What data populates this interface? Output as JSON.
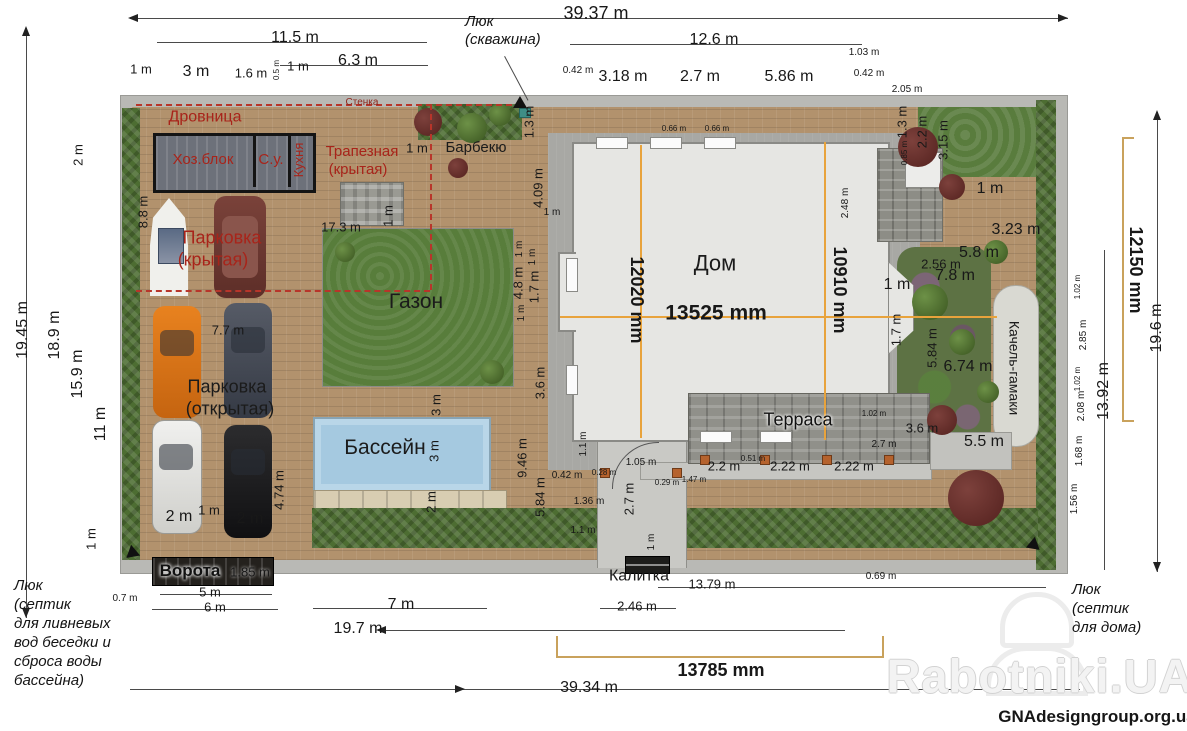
{
  "areas": {
    "drovnitsa": "Дровница",
    "hozblok": "Хоз.блок",
    "su": "С.у.",
    "kuhnya": "Кухня",
    "trapeznaya_1": "Трапезная",
    "trapeznaya_2": "(крытая)",
    "barbekyu": "Барбекю",
    "stenka": "Стенка",
    "park_kr_1": "Парковка",
    "park_kr_2": "(крытая)",
    "park_ot_1": "Парковка",
    "park_ot_2": "(открытая)",
    "gazon": "Газон",
    "bassein": "Бассейн",
    "dom": "Дом",
    "terrasa": "Терраса",
    "vorota": "Ворота",
    "kalitka": "Калитка",
    "kacheli": "Качель-гамаки"
  },
  "annotations": {
    "well": [
      "Люк",
      "(скважина)"
    ],
    "septic_left": [
      "Люк",
      "(септик",
      "для ливневых",
      "вод беседки и",
      "сброса воды",
      "бассейна)"
    ],
    "septic_right": [
      "Люк",
      "(септик",
      "для дома)"
    ]
  },
  "watermark": {
    "brand": "Rabotniki.UA",
    "site": "GNAdesigngroup.org.ua"
  },
  "dims": [
    {
      "t": "39.37 m"
    },
    {
      "t": "11.5 m"
    },
    {
      "t": "6.3 m"
    },
    {
      "t": "1 m"
    },
    {
      "t": "3 m"
    },
    {
      "t": "1.6 m"
    },
    {
      "t": "0.5 m"
    },
    {
      "t": "1 m"
    },
    {
      "t": "12.6 m"
    },
    {
      "t": "0.42 m"
    },
    {
      "t": "3.18 m"
    },
    {
      "t": "2.7 m"
    },
    {
      "t": "5.86 m"
    },
    {
      "t": "1.03 m"
    },
    {
      "t": "0.42 m"
    },
    {
      "t": "2.05 m"
    },
    {
      "t": "1.3 m"
    },
    {
      "t": "1.3 m"
    },
    {
      "t": "0.85 m"
    },
    {
      "t": "2.2 m"
    },
    {
      "t": "3.15 m"
    },
    {
      "t": "0.66 m"
    },
    {
      "t": "0.66 m"
    },
    {
      "t": "19.45 m"
    },
    {
      "t": "18.9 m"
    },
    {
      "t": "15.9 m"
    },
    {
      "t": "11 m"
    },
    {
      "t": "2 m"
    },
    {
      "t": "8.8 m"
    },
    {
      "t": "1 m"
    },
    {
      "t": "0.7 m"
    },
    {
      "t": "17.3 m"
    },
    {
      "t": "1 m"
    },
    {
      "t": "7.7 m"
    },
    {
      "t": "4.09 m"
    },
    {
      "t": "1 m"
    },
    {
      "t": "1 m"
    },
    {
      "t": "1 m"
    },
    {
      "t": "4.8 m"
    },
    {
      "t": "1.7 m"
    },
    {
      "t": "1 m"
    },
    {
      "t": "3.6 m"
    },
    {
      "t": "9.46 m"
    },
    {
      "t": "5.84 m"
    },
    {
      "t": "1.1 m"
    },
    {
      "t": "0.42 m"
    },
    {
      "t": "1.36 m"
    },
    {
      "t": "1.1 m"
    },
    {
      "t": "1 m"
    },
    {
      "t": "3 m"
    },
    {
      "t": "3 m"
    },
    {
      "t": "2 m"
    },
    {
      "t": "4.74 m"
    },
    {
      "t": "2 m"
    },
    {
      "t": "1 m"
    },
    {
      "t": "2 m"
    },
    {
      "t": "1.85 m"
    },
    {
      "t": "5 m"
    },
    {
      "t": "6 m"
    },
    {
      "t": "7 m"
    },
    {
      "t": "19.7 m"
    },
    {
      "t": "2.46 m"
    },
    {
      "t": "13.79 m"
    },
    {
      "t": "0.69 m"
    },
    {
      "t": "13785 mm"
    },
    {
      "t": "39.34 m"
    },
    {
      "t": "1.05 m"
    },
    {
      "t": "2.7 m"
    },
    {
      "t": "1 m"
    },
    {
      "t": "2.2 m"
    },
    {
      "t": "0.51 m"
    },
    {
      "t": "2.22 m"
    },
    {
      "t": "2.22 m"
    },
    {
      "t": "1.47 m"
    },
    {
      "t": "0.29 m"
    },
    {
      "t": "2.7 m"
    },
    {
      "t": "1.02 m"
    },
    {
      "t": "3.6 m"
    },
    {
      "t": "5.5 m"
    },
    {
      "t": "2.48 m"
    },
    {
      "t": "1 m"
    },
    {
      "t": "3.23 m"
    },
    {
      "t": "5.8 m"
    },
    {
      "t": "2.56 m"
    },
    {
      "t": "7.8 m"
    },
    {
      "t": "1 m"
    },
    {
      "t": "1.7 m"
    },
    {
      "t": "5.84 m"
    },
    {
      "t": "6.74 m"
    },
    {
      "t": "1.02 m"
    },
    {
      "t": "2.85 m"
    },
    {
      "t": "1.02 m"
    },
    {
      "t": "2.08 m"
    },
    {
      "t": "1.68 m"
    },
    {
      "t": "1.56 m"
    },
    {
      "t": "13.92 m"
    },
    {
      "t": "19.6 m"
    },
    {
      "t": "12150 mm"
    },
    {
      "t": "12020 mm"
    },
    {
      "t": "10910 mm"
    },
    {
      "t": "13525 mm"
    },
    {
      "t": "0.28 m"
    }
  ]
}
